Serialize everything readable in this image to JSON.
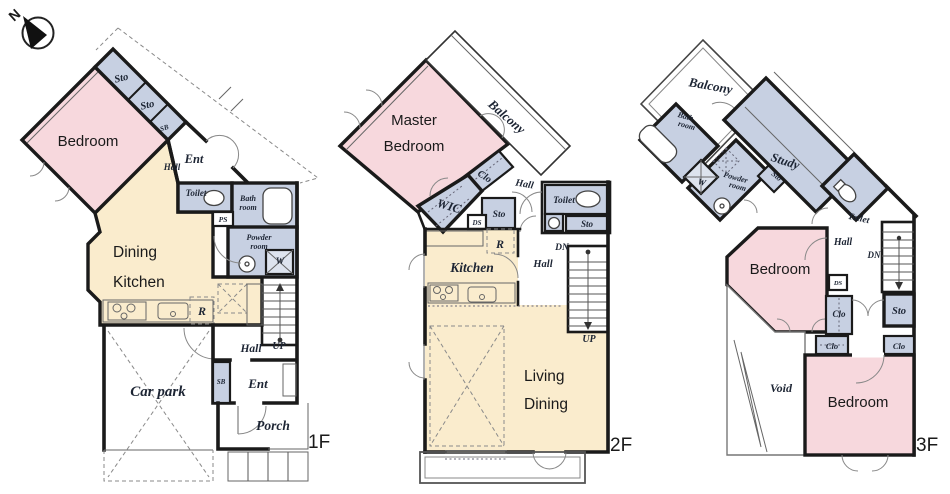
{
  "compass": {
    "north": "N"
  },
  "colors": {
    "bedroom_pink": "#f7d8dd",
    "living_cream": "#faeccd",
    "service_blue": "#c7d0e2",
    "service_blue_light": "#dde3ee",
    "hatch_cream": "#f6e9cf",
    "wall_black": "#1a1a1a"
  },
  "floors": [
    {
      "tag": "1F",
      "labels": {
        "bedroom": "Bedroom",
        "sto_a": "Sto",
        "sto_b": "Sto",
        "sb_upper": "SB",
        "hall_upper": "Hall",
        "ent_upper": "Ent",
        "toilet": "Toilet",
        "ps": "PS",
        "bath_1": "Bath",
        "bath_2": "room",
        "powder_1": "Powder",
        "powder_2": "room",
        "w": "W",
        "dining_1": "Dining",
        "dining_2": "Kitchen",
        "r": "R",
        "hall": "Hall",
        "up": "UP",
        "sb": "SB",
        "ent": "Ent",
        "carpark": "Car park",
        "porch": "Porch"
      }
    },
    {
      "tag": "2F",
      "labels": {
        "master_1": "Master",
        "master_2": "Bedroom",
        "balcony": "Balcony",
        "clo": "Clo",
        "wic": "WIC",
        "ds": "DS",
        "sto_a": "Sto",
        "hall_upper": "Hall",
        "toilet": "Toilet",
        "sto_b": "Sto",
        "dn": "DN",
        "hall": "Hall",
        "kitchen": "Kitchen",
        "r": "R",
        "up": "UP",
        "living_1": "Living",
        "living_2": "Dining"
      }
    },
    {
      "tag": "3F",
      "labels": {
        "balcony": "Balcony",
        "bath_1": "Bath",
        "bath_2": "room",
        "w": "W",
        "powder_1": "Powder",
        "powder_2": "room",
        "sto_small": "Sto",
        "study": "Study",
        "toilet": "Toilet",
        "hall": "Hall",
        "dn": "DN",
        "ds": "DS",
        "bedroom_a": "Bedroom",
        "clo_mid": "Clo",
        "sto": "Sto",
        "clo_left": "Clo",
        "clo_right": "Clo",
        "void": "Void",
        "bedroom_b": "Bedroom"
      }
    }
  ]
}
